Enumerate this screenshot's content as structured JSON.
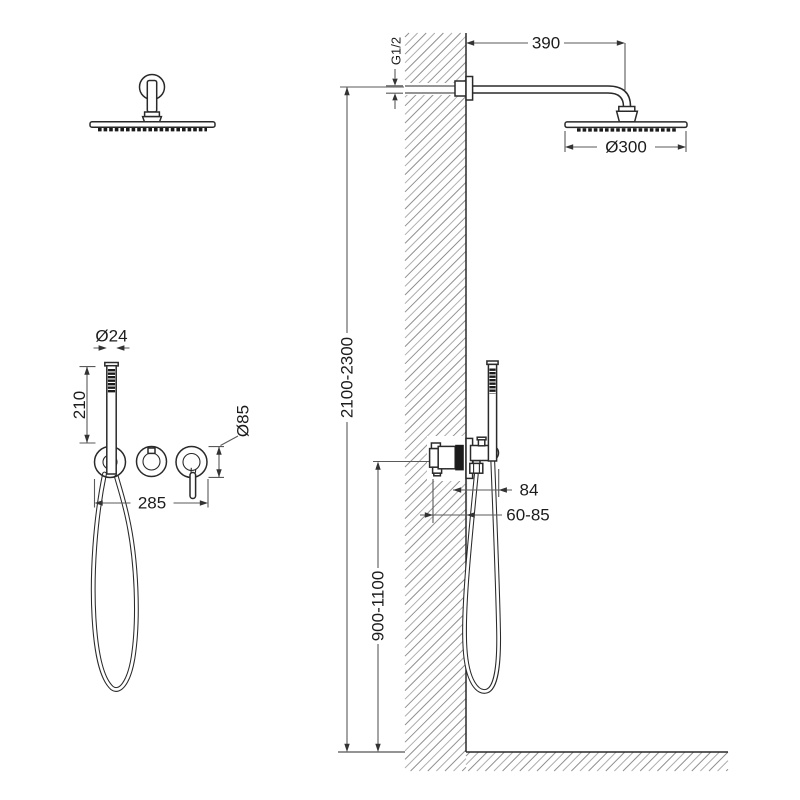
{
  "diagram": {
    "labels": {
      "arm_length": "390",
      "thread_size": "G1/2",
      "head_diameter": "Ø300",
      "handle_diameter": "Ø24",
      "hand_shower_length": "210",
      "escutcheon_diameter": "Ø85",
      "trim_width": "285",
      "holder_projection": "84",
      "install_depth": "60-85",
      "valve_height_range": "900-1100",
      "head_height_range": "2100-2300"
    },
    "colors": {
      "background": "#ffffff",
      "line": "#2a2a2a",
      "dim_line": "#5a5a5a",
      "text": "#1c1c1c",
      "dark_fill": "#1b1b1b",
      "hatch": "#8f8f8f",
      "hatch_alt": "#adadad"
    }
  }
}
